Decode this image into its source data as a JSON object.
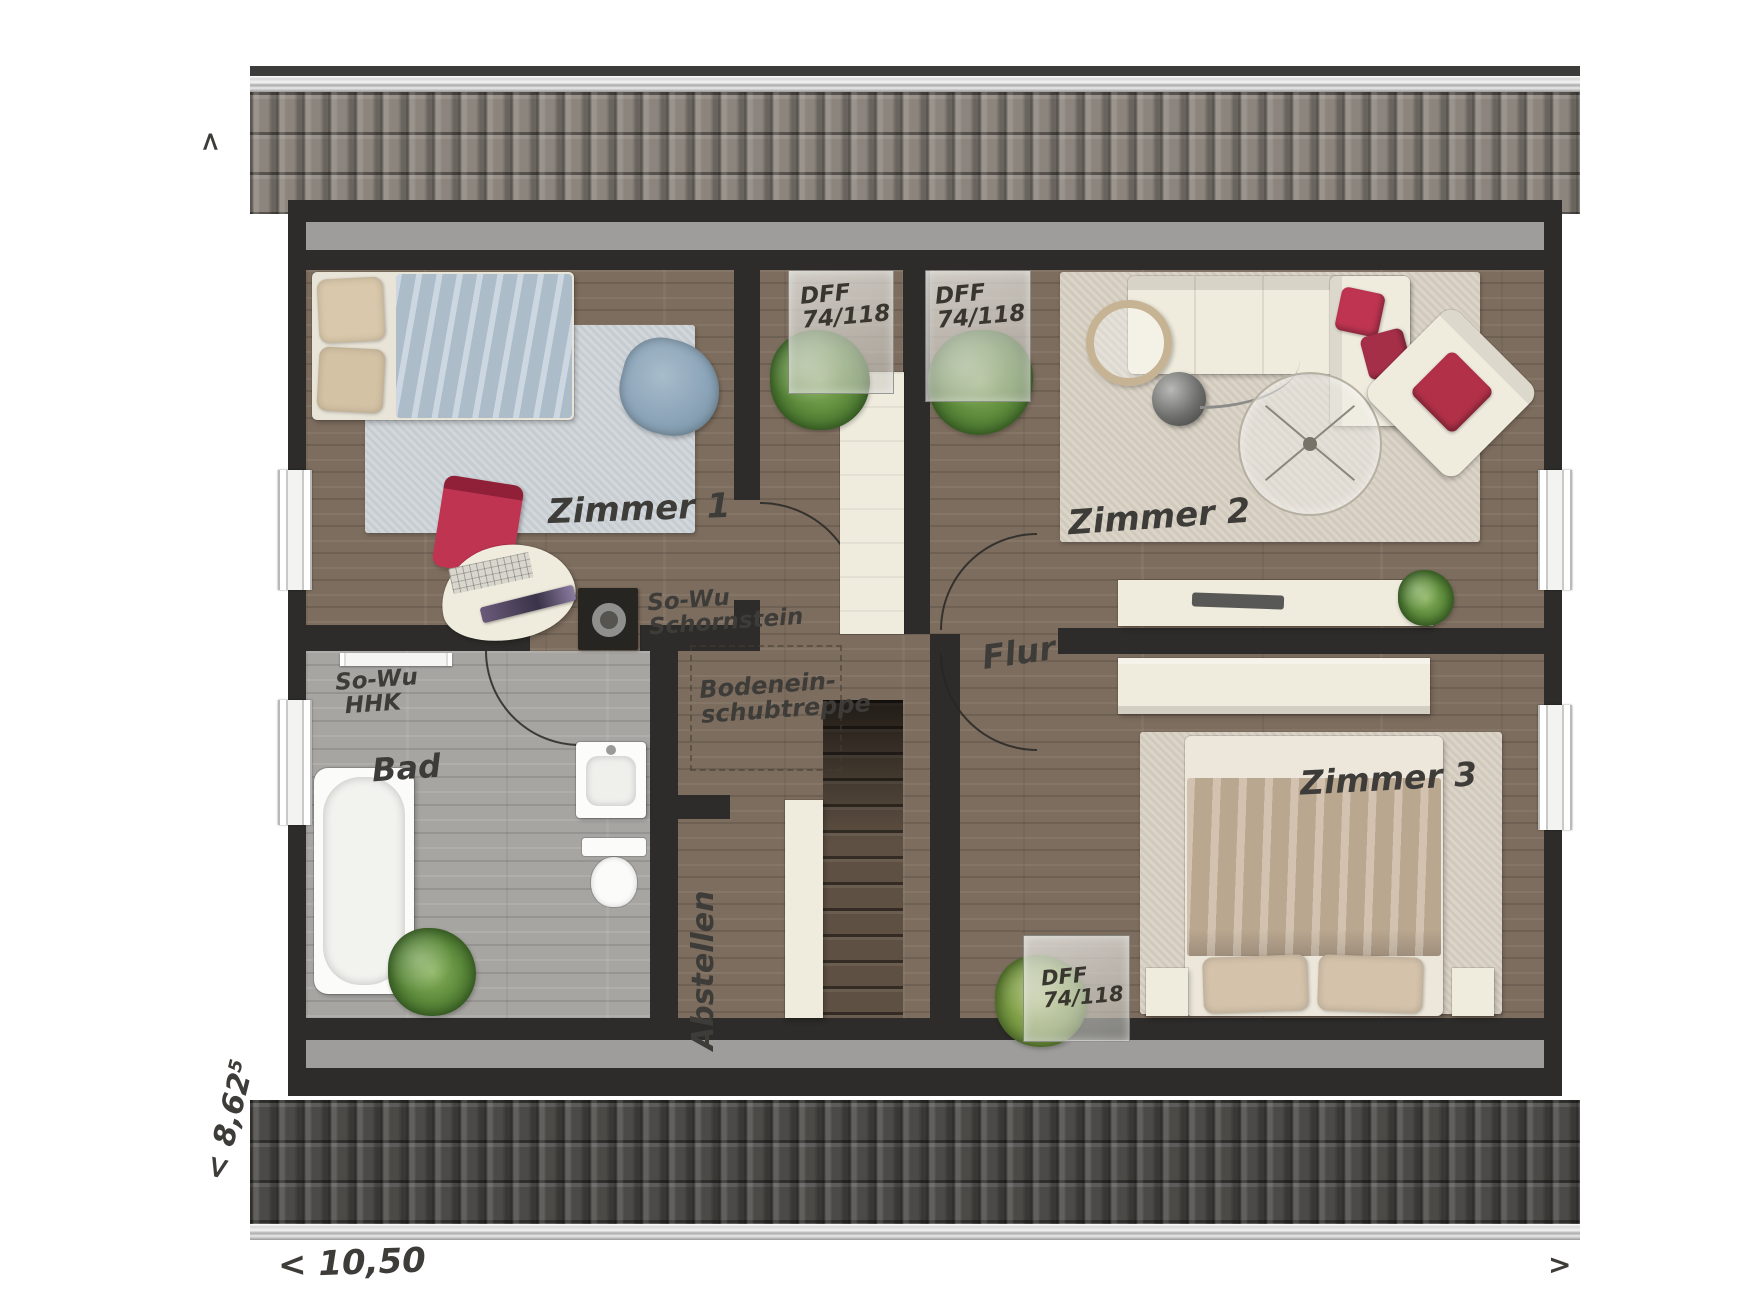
{
  "labels": {
    "zimmer1": "Zimmer 1",
    "zimmer2": "Zimmer 2",
    "zimmer3": "Zimmer 3",
    "bad": "Bad",
    "flur": "Flur",
    "abstellen": "Abstellen"
  },
  "annotations": {
    "skylight1": {
      "line1": "DFF",
      "line2": "74/118"
    },
    "skylight2": {
      "line1": "DFF",
      "line2": "74/118"
    },
    "skylight3": {
      "line1": "DFF",
      "line2": "74/118"
    },
    "chimney": {
      "line1": "So-Wu",
      "line2": "Schornstein"
    },
    "heater": {
      "line1": "So-Wu",
      "line2": "HHK"
    },
    "attic_hatch": {
      "line1": "Bodenein-",
      "line2": "schubtreppe"
    }
  },
  "dimensions": {
    "width_label": "< 10,50",
    "height_label": "< 8,62",
    "height_sup": "5",
    "arrow_top": ">",
    "arrow_right": ">"
  },
  "colors": {
    "wall": "#2d2c2a",
    "wood": "#7d6d5e",
    "bath_floor": "#a7a5a1",
    "knee": "#9e9d9b",
    "roof_top": "#8c857d",
    "roof_bottom": "#4b4a47",
    "ridge": "#3c3c3a",
    "cream": "#efebdd",
    "accent_red": "#bf3551",
    "rug_blue": "#cdd3d8",
    "rug_beige": "#d7cfc2",
    "blanket_blue": "#b6c6d4",
    "blanket_tan": "#c5b199"
  }
}
